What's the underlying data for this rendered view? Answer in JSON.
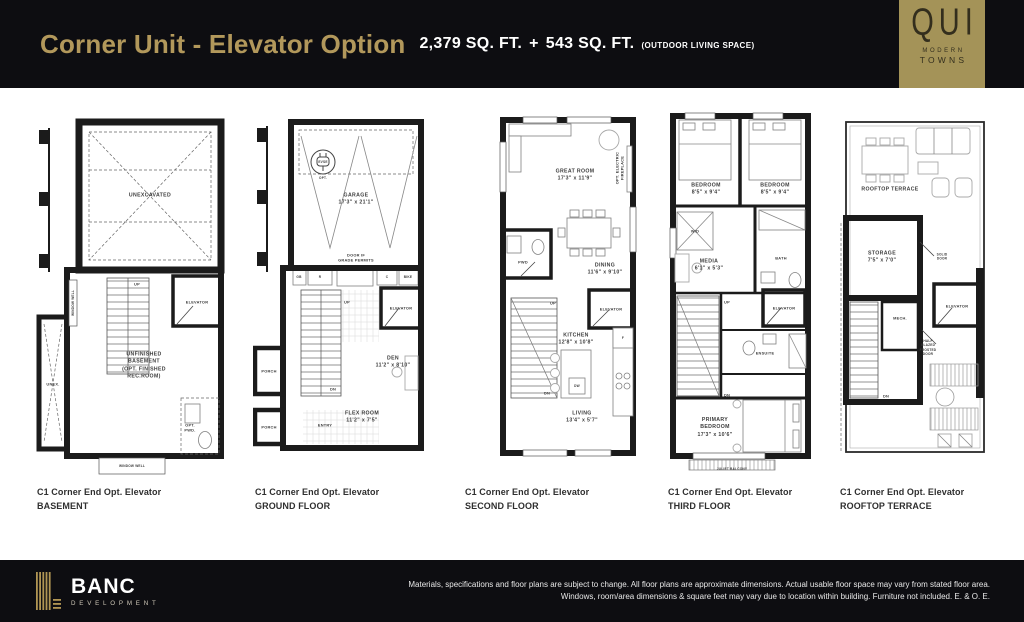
{
  "header": {
    "title": "Corner Unit - Elevator Option",
    "area_main": "2,379 SQ. FT.",
    "area_plus": "+",
    "area_outdoor": "543 SQ. FT.",
    "area_note": "(OUTDOOR LIVING SPACE)"
  },
  "brand": {
    "logo_text": "QUI",
    "logo_sub1": "MODERN",
    "logo_sub2": "TOWNS"
  },
  "colors": {
    "gold_accent": "#b2985b",
    "logo_gold": "#a49358",
    "bar_black": "#0d0d11"
  },
  "plans": {
    "basement": {
      "caption1": "C1 Corner End Opt. Elevator",
      "caption2": "BASEMENT",
      "labels": {
        "unexcavated": "UNEXCAVATED",
        "up": "UP",
        "elevator": "ELEVATOR",
        "window_well_side": "WINDOW WELL",
        "room": "UNFINISHED\nBASEMENT\n(OPT. FINISHED\nREC.ROOM)",
        "unex": "UNEX.",
        "opt_pwd": "OPT.\nPWD.",
        "window_well_bottom": "WINDOW WELL"
      }
    },
    "ground": {
      "caption1": "C1 Corner End Opt. Elevator",
      "caption2": "GROUND FLOOR",
      "labels": {
        "evse": "EVSE",
        "opt": "OPT.",
        "garage": "GARAGE\n17'3\" x 21'1\"",
        "door_note": "DOOR IF\nGRADE PERMITS",
        "gb": "GB",
        "r": "R",
        "c": "C",
        "bike": "BIKE",
        "up": "UP",
        "elevator": "ELEVATOR",
        "den": "DEN\n11'2\" x 8'10\"",
        "dn": "DN",
        "porch1": "PORCH",
        "porch2": "PORCH",
        "entry": "ENTRY",
        "flex": "FLEX ROOM\n11'2\" x 7'5\""
      }
    },
    "second": {
      "caption1": "C1 Corner End Opt. Elevator",
      "caption2": "SECOND FLOOR",
      "labels": {
        "great_room": "GREAT ROOM\n17'3\" x 11'9\"",
        "fireplace": "OPT. ELECTRIC\nFIREPLACE",
        "pwd": "PWD",
        "dining": "DINING\n11'6\" x 9'10\"",
        "up": "UP",
        "elevator": "ELEVATOR",
        "kitchen": "KITCHEN\n12'8\" x 10'8\"",
        "dw": "DW",
        "f": "F",
        "dn": "DN",
        "living": "LIVING\n13'4\" x 5'7\""
      }
    },
    "third": {
      "caption1": "C1 Corner End Opt. Elevator",
      "caption2": "THIRD FLOOR",
      "labels": {
        "bedroom1": "BEDROOM\n8'5\" x 9'4\"",
        "bedroom2": "BEDROOM\n8'5\" x 9'4\"",
        "wd": "W/D",
        "media": "MEDIA\n6'1\" x 5'3\"",
        "bath": "BATH",
        "up": "UP",
        "elevator": "ELEVATOR",
        "ensuite": "ENSUITE",
        "dn": "DN",
        "primary": "PRIMARY\nBEDROOM\n17'3\" x 10'6\"",
        "juliet": "JULIET BALCONY"
      }
    },
    "rooftop": {
      "caption1": "C1 Corner End Opt. Elevator",
      "caption2": "ROOFTOP TERRACE",
      "labels": {
        "terrace": "ROOFTOP TERRACE",
        "storage": "STORAGE\n7'5\" x 7'0\"",
        "solid_door": "SOLID\nDOOR",
        "mech": "MECH.",
        "elevator": "ELEVATOR",
        "half_glazed": "HALF\nGLAZED\nFROSTED\nDOOR",
        "dn": "DN"
      }
    }
  },
  "footer": {
    "brand_name": "BANC",
    "brand_sub": "DEVELOPMENT",
    "disclaimer1": "Materials, specifications and floor plans are subject to change. All floor plans are approximate dimensions. Actual usable floor space may vary from stated floor area.",
    "disclaimer2": "Windows, room/area dimensions & square feet may vary due to location within building. Furniture not included. E. & O. E."
  }
}
